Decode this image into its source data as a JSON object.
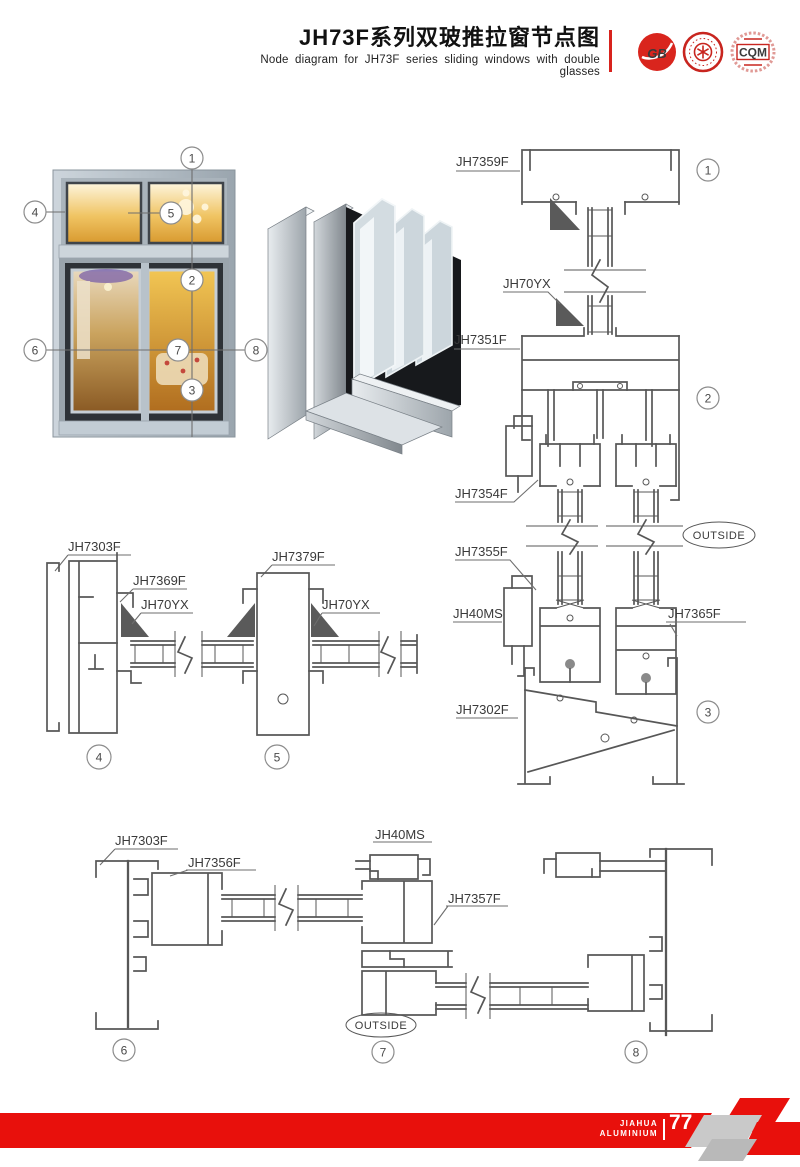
{
  "header": {
    "title_cn": "JH73F系列双玻推拉窗节点图",
    "title_en": "Node diagram for JH73F series sliding windows with double glasses",
    "logos": {
      "gb_text": "GB",
      "cqm_text": "CQM"
    }
  },
  "overview": {
    "callouts": [
      "1",
      "2",
      "3",
      "4",
      "5",
      "6",
      "7",
      "8"
    ]
  },
  "right_diagram": {
    "detail1": {
      "num": "1",
      "labels": {
        "top_frame": "JH7359F",
        "gasket": "JH70YX",
        "transom": "JH7351F"
      }
    },
    "detail2": {
      "num": "2",
      "labels": {
        "sash_top": "JH7354F",
        "outside": "OUTSIDE",
        "sash_bottom": "JH7355F",
        "lock": "JH40MS",
        "sash_right": "JH7365F"
      }
    },
    "detail3": {
      "num": "3",
      "labels": {
        "sill": "JH7302F"
      }
    }
  },
  "mid_diagram": {
    "detail4": {
      "num": "4",
      "labels": {
        "frame": "JH7303F",
        "sash": "JH7369F",
        "gasket": "JH70YX"
      }
    },
    "detail5": {
      "num": "5",
      "labels": {
        "interlock": "JH7379F",
        "gasket": "JH70YX"
      }
    }
  },
  "bottom_diagram": {
    "detail6": {
      "num": "6",
      "labels": {
        "frame": "JH7303F",
        "sash": "JH7356F"
      }
    },
    "detail7": {
      "num": "7",
      "labels": {
        "lock": "JH40MS",
        "sash": "JH7357F",
        "outside": "OUTSIDE"
      }
    },
    "detail8": {
      "num": "8"
    }
  },
  "footer": {
    "brand_line1": "JIAHUA",
    "brand_line2": "ALUMINIUM",
    "page_number": "77"
  }
}
